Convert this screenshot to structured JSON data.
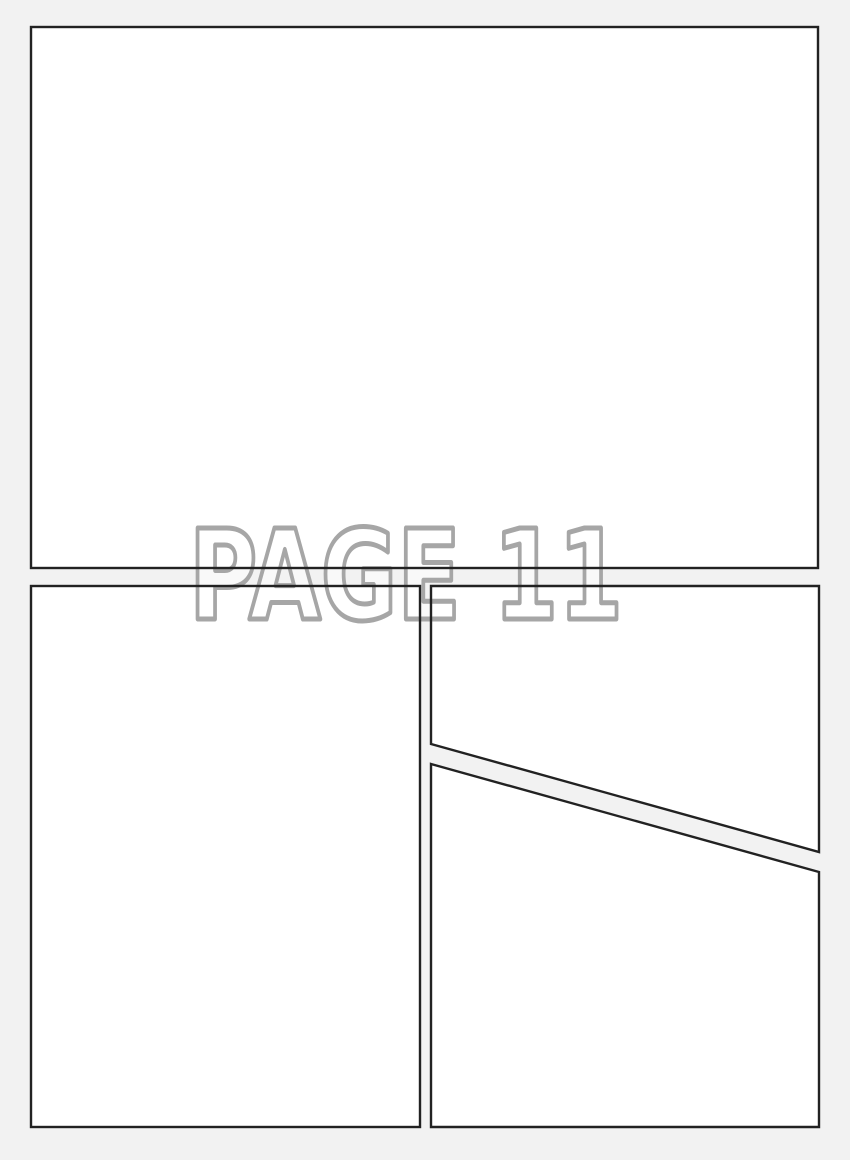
{
  "page_label": {
    "text": "PAGE 11"
  },
  "colors": {
    "background": "#f2f2f2",
    "panel_fill": "#ffffff",
    "panel_border": "#222222",
    "label_outline": "#a6a6a6"
  },
  "panel_count": 4
}
